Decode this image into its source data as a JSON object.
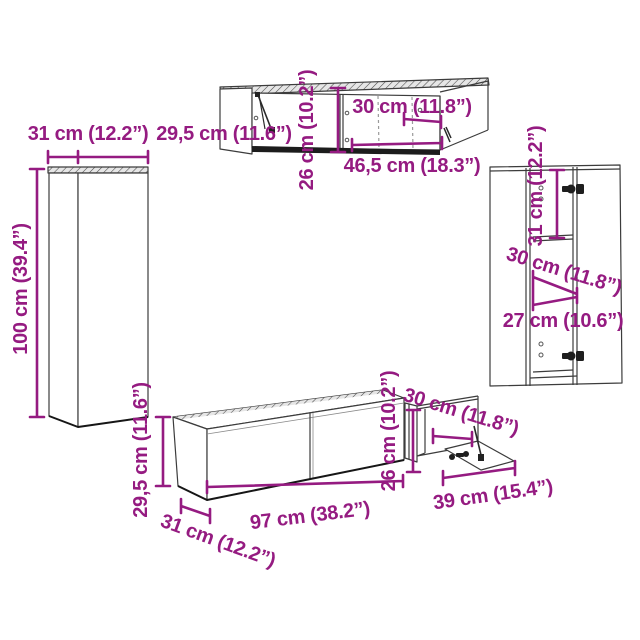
{
  "diagram_type": "furniture-dimension-diagram",
  "colors": {
    "dimension_accent": "#951B81",
    "outline": "#3C3C3C",
    "dark_edge": "#161616",
    "background": "#FFFFFF"
  },
  "pieces": {
    "left_tall_cabinet": {
      "width_label": "31 cm (12.2”)",
      "height_label": "100 cm (39.4”)"
    },
    "top_wall_cabinet": {
      "side_label": "29,5 cm (11.6”)",
      "height_label": "26 cm (10.2”)",
      "depth_label": "30 cm (11.8”)",
      "width_label": "46,5 cm (18.3”)"
    },
    "right_tall_cabinet": {
      "inner_height_label": "31 cm (12.2”)",
      "depth_label": "30 cm (11.8”)",
      "width_label": "27 cm (10.6”)"
    },
    "tv_bench": {
      "height_label": "29,5 cm (11.6”)",
      "depth_label": "31 cm (12.2”)",
      "width_label": "97 cm (38.2”)"
    },
    "open_side_cabinet": {
      "height_label": "26 cm (10.2”)",
      "depth_label": "30 cm (11.8”)",
      "width_label": "39 cm (15.4”)"
    }
  }
}
